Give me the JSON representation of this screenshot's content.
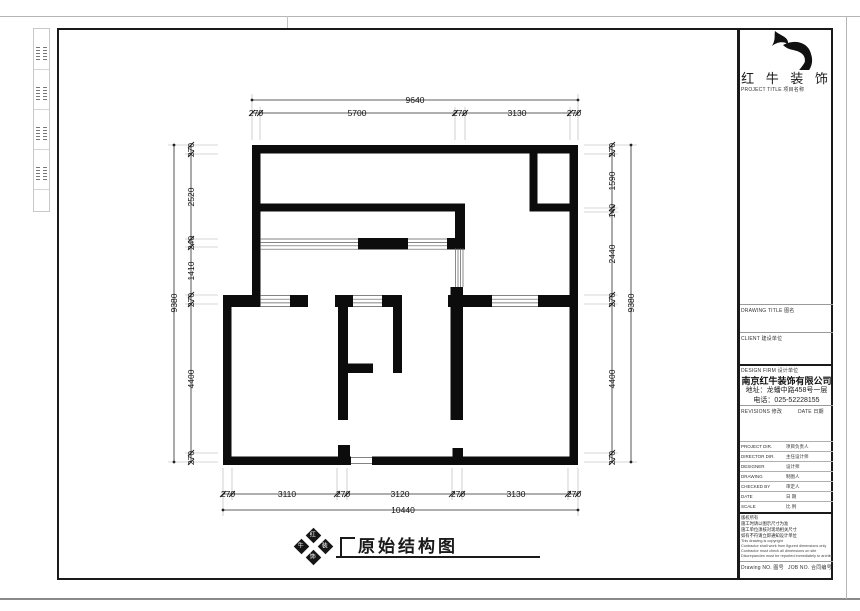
{
  "title_block": {
    "brand": "红 牛 装 饰",
    "labels": {
      "project_title": "PROJECT TITLE  项目名称",
      "drawing_title": "DRAWING TITLE  图名",
      "client": "CLIENT  建设单位",
      "design_firm": "DESIGN FIRM  设计单位",
      "revisions": "REVISIONS  修改",
      "date": "DATE  日期",
      "drawing_no": "Drawing NO.  图号",
      "job_no": "JOB NO.  合同编号"
    },
    "company": {
      "name": "南京红牛装饰有限公司",
      "address": "地址：龙蟠中路458号一层",
      "phone": "电话：025-52228155"
    },
    "rows": [
      {
        "en": "PROJECT DIR.",
        "cn": "项目负责人"
      },
      {
        "en": "DIRECTOR DIR.",
        "cn": "主任设计师"
      },
      {
        "en": "DESIGNER",
        "cn": "设计师"
      },
      {
        "en": "DRAWING",
        "cn": "制图人"
      },
      {
        "en": "CHECKED BY",
        "cn": "审定人"
      },
      {
        "en": "DATE",
        "cn": "日 期"
      },
      {
        "en": "SCALE",
        "cn": "比 例"
      }
    ],
    "notes": [
      "版权所有",
      "施工时请以图示尺寸为准",
      "施工单位须核对现场相关尺寸",
      "如有不符请立即通知设计单位",
      "This drawing is copyright",
      "Contractor shall work from figured dimensions only",
      "Contractor must check all dimensions on site",
      "Discrepancies must be reported immediately to architects"
    ]
  },
  "drawing": {
    "title": "原始结构图",
    "stamp": [
      "红",
      "牛",
      "装",
      "饰"
    ],
    "dimensions": {
      "top_total": "9640",
      "top": [
        "270",
        "5700",
        "270",
        "3130",
        "270"
      ],
      "bottom": [
        "270",
        "3110",
        "270",
        "3120",
        "270",
        "3130",
        "270"
      ],
      "bottom_total": "10440",
      "left_total": "9380",
      "left": [
        "270",
        "2520",
        "240",
        "1410",
        "270",
        "4400",
        "270"
      ],
      "right": [
        "270",
        "1590",
        "140",
        "2440",
        "270",
        "4400",
        "270"
      ],
      "right_total": "9380"
    }
  }
}
